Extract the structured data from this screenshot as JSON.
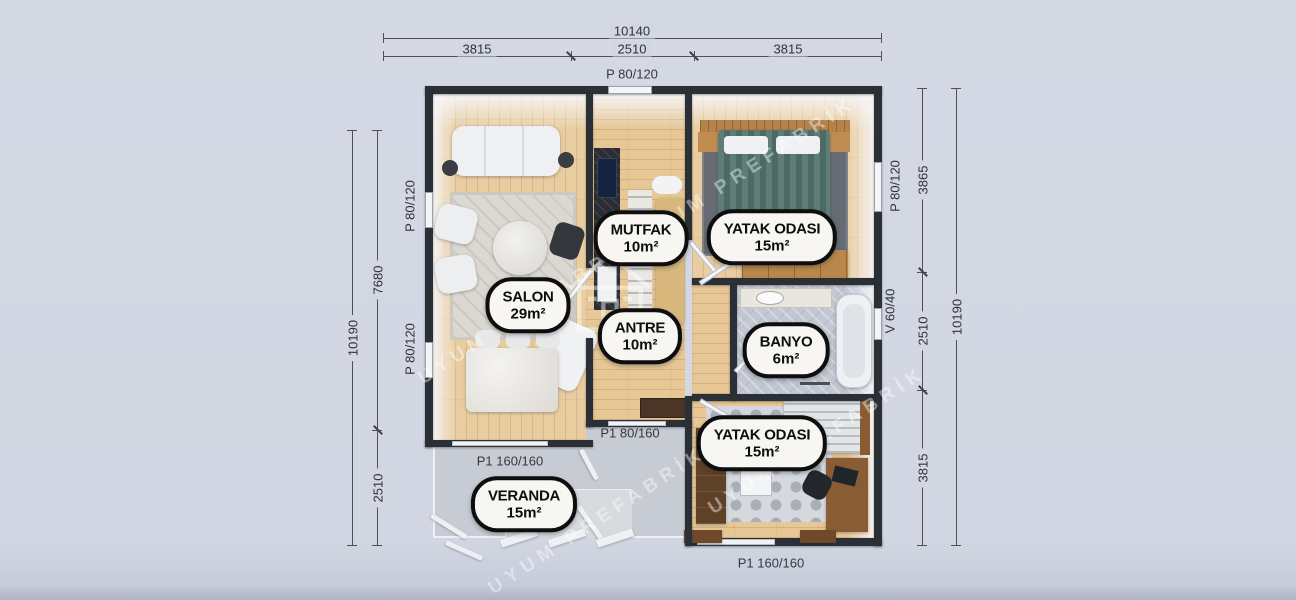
{
  "meta": {
    "type": "prefab-house-floor-plan",
    "background": "#d3d7e2",
    "wall_color": "#2b2f36",
    "accent_wood": "#e6c795"
  },
  "dimensions": {
    "top_overall": "10140",
    "top_segments": [
      "3815",
      "2510",
      "3815"
    ],
    "left_overall": "10190",
    "left_segments": [
      "7680",
      "2510"
    ],
    "right_overall": "10190",
    "right_segments": [
      "3865",
      "2510",
      "3815"
    ]
  },
  "openings": {
    "window_top": "P 80/120",
    "window_left_upper": "P 80/120",
    "window_left_lower": "P 80/120",
    "window_right_bedroom": "P 80/120",
    "vent_right_bath": "V 60/40",
    "door_entry": "P1 80/160",
    "door_salon_veranda": "P1 160/160",
    "door_bedroom_terrace": "P1 160/160"
  },
  "rooms": {
    "mutfak": {
      "name": "MUTFAK",
      "area": "10m²"
    },
    "yatak1": {
      "name": "YATAK ODASI",
      "area": "15m²"
    },
    "salon": {
      "name": "SALON",
      "area": "29m²"
    },
    "antre": {
      "name": "ANTRE",
      "area": "10m²"
    },
    "banyo": {
      "name": "BANYO",
      "area": "6m²"
    },
    "yatak2": {
      "name": "YATAK ODASI",
      "area": "15m²"
    },
    "veranda": {
      "name": "VERANDA",
      "area": "15m²"
    }
  },
  "watermark": {
    "text": "UYUM PREFABRİK"
  }
}
